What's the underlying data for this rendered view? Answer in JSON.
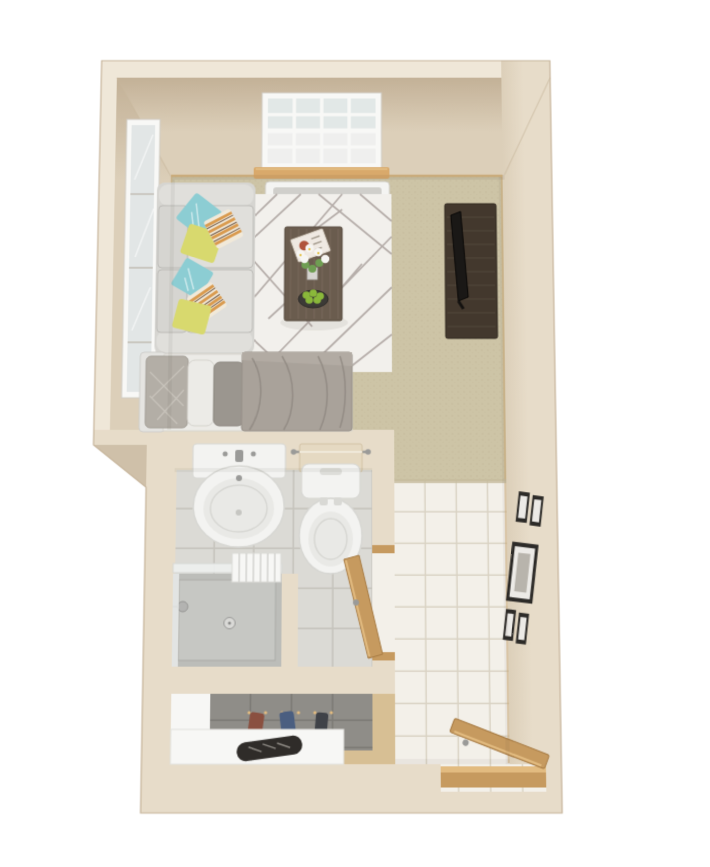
{
  "meta": {
    "title": "3D top-down floor plan render of a studio apartment",
    "view": "bird's-eye 3D dollhouse render",
    "rooms": [
      "living-sleeping room",
      "bathroom",
      "closet",
      "entry hall"
    ],
    "inventory": {
      "living": [
        "sofa with teal, yellow and striped accent pillows",
        "geometric area rug",
        "coffee table with magazine, white flowers and fruit bowl",
        "tv stand with flat tv",
        "bed with gray duvet and pillows",
        "tall wall mirror",
        "gridded window with sheer curtain and wood sill",
        "baseboard heater"
      ],
      "bathroom": [
        "pedestal sink",
        "toilet with towel bar",
        "walk-in shower with glass panel and towels",
        "wooden swing door"
      ],
      "closet": [
        "gray tiled back wall",
        "hanging clothes on pegs",
        "white shoe counter with shoes"
      ],
      "entry": [
        "white tile floor",
        "five gallery picture frames",
        "wooden entry door with threshold"
      ]
    }
  },
  "palette": {
    "background": "#ffffff",
    "wall_top": "#e7dcc9",
    "wall_outer": "#efe7d8",
    "wall_face": "#dccfb9",
    "wall_face_dark": "#c3b197",
    "wall_bevel": "#cfc0a9",
    "wall_edge": "#c6b49a",
    "baseboard": "#d4b27c",
    "carpet": "#cdc4a6",
    "carpet_dot": "#c2b899",
    "rug": "#f2f0ec",
    "rug_line": "#b6aeaa",
    "tile": "#f3f0e9",
    "tile_grout": "#d9d2c3",
    "tile_threshold": "#c6bb9e",
    "bath_tile": "#dbdad5",
    "bath_grout": "#c6c4bd",
    "shower_floor": "#bcbdb9",
    "shower_tray": "#c6c7c3",
    "shower_glass": "#eef0ef",
    "closet_wall": "#8f8d88",
    "closet_grout": "#7c7a75",
    "closet_floor": "#d7bf94",
    "white_panel": "#f7f7f5",
    "porcelain": "#f3f3f1",
    "porcelain_shadow": "#d7d7d3",
    "basin": "#e9e9e6",
    "metal": "#9a9a98",
    "towel": "#e5d9c2",
    "wood_door": "#c69a5f",
    "wood_light": "#e2bb80",
    "wood_dark": "#a87c44",
    "sill": "#d9a96b",
    "window_frame": "#f8f8f6",
    "glass": "#e2e8e7",
    "curtain": "#f1f0ee",
    "heater": "#f4f4f2",
    "heater_slot": "#d0cfcb",
    "mirror_glass": "#e2e6e6",
    "couch": "#d6d5d1",
    "couch_light": "#e0dfdb",
    "couch_shadow": "#bcbbb7",
    "pillow_teal": "#8ccdd3",
    "pillow_yellow": "#d8d96e",
    "pillow_cream": "#f1e9d9",
    "pillow_stripe": "#d99a4e",
    "tv_cabinet": "#43382d",
    "tv_grain": "#5a4e40",
    "tv_screen": "#1a1816",
    "table_wood": "#6a5c4e",
    "table_grain": "#7d6f60",
    "bowl": "#3c3a36",
    "fruit": "#8ab83a",
    "leaf": "#6f9e52",
    "flower": "#f6f5f2",
    "flower_center": "#e4c24a",
    "magazine": "#efe9e2",
    "magazine_art": "#b0543c",
    "headboard": "#e5e4e1",
    "bed_sheet": "#ecebe7",
    "bed_pillow_gray": "#9b968f",
    "bed_pillow_pattern": "#b3aea6",
    "bed_duvet": "#a9a29a",
    "bed_duvet_flap": "#b2aba3",
    "bed_duvet_fold": "#918a82",
    "frame_dark": "#2d2b28",
    "frame_mat": "#eceae6",
    "frame_art": "#b8b4ac",
    "clothes_red": "#8a5040",
    "clothes_blue": "#4a5e80",
    "clothes_dark": "#3f4248",
    "shoe": "#2f2c29"
  }
}
